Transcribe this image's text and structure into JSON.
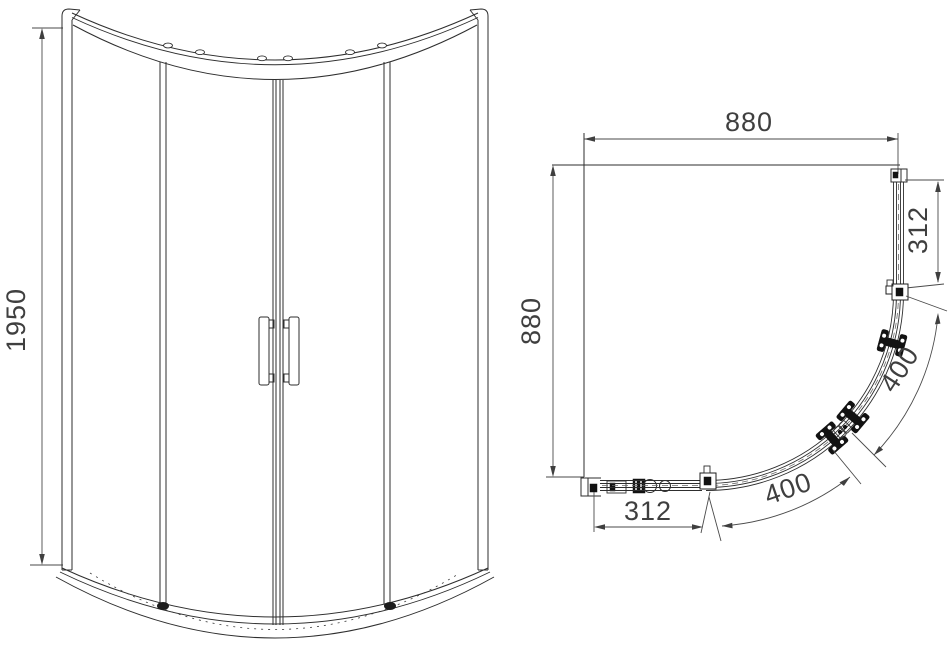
{
  "drawing": {
    "subject": "quadrant-shower-enclosure-technical-drawing",
    "background_color": "#ffffff",
    "line_color": "#2e2e2e",
    "dimension_text_color": "#3f3f3f",
    "hardware_color": "#121212",
    "elevation": {
      "dim_height": "1950"
    },
    "plan": {
      "dim_width": "880",
      "dim_depth": "880",
      "dim_right_panel": "312",
      "dim_bottom_panel": "312",
      "dim_door_upper": "400",
      "dim_door_lower": "400"
    }
  }
}
